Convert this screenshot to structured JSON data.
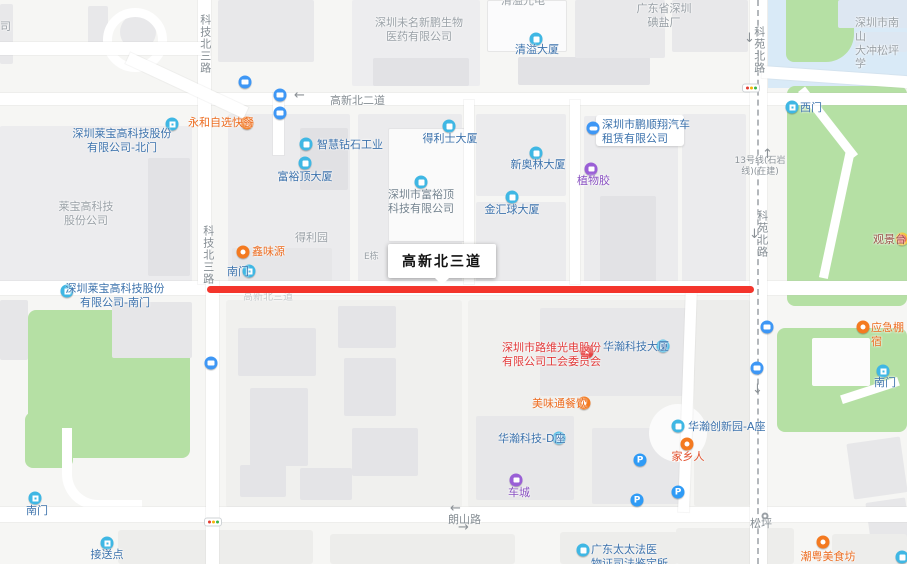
{
  "map": {
    "callout": "高新北三道",
    "roads": {
      "keji_north_3_a": "科技北三路",
      "keji_north_3_b": "科技北三路",
      "gaoxin_north_2": "高新北二道",
      "gaoxin_north_3": "高新北三道",
      "langshan": "朗山路",
      "keyuan_north_a": "科苑北路",
      "keyuan_north_b": "科苑北路",
      "songping": "松坪",
      "metro_line_13": "13号线(石岩\n线)(在建)"
    },
    "pois": {
      "weiming_biopharma": "深圳未名新鹏生物\n医药有限公司",
      "qingyi_optoelectronics": "清溢光电",
      "iodized_salt_factory": "广东省深圳\n碘盐厂",
      "songping_school": "深圳市南山\n大冲松坪学",
      "laibao_hightech": "莱宝高科技\n股份公司",
      "deliyuan": "得利园",
      "building_e": "E栋",
      "edge_fragment_si": "司",
      "qingyi_tower": "清溢大厦",
      "west_gate": "西门",
      "laibao_north_gate": "深圳莱宝高科技股份\n有限公司-北门",
      "zhihui_diamond": "智慧钻石工业",
      "delishi_tower": "得利士大厦",
      "fuyuding_tower": "富裕顶大厦",
      "pengshunxiang_car_rental": "深圳市鹏顺翔汽车\n租赁有限公司",
      "xinaolin_tower": "新奥林大厦",
      "fuyuding_tech": "深圳市富裕顶\n科技有限公司",
      "jinhuiqiu_tower": "金汇球大厦",
      "south_gate_center": "南门",
      "laibao_south_gate": "深圳莱宝高科技股份\n有限公司-南门",
      "xinweiyuan": "鑫味源",
      "yonghe_fastfood": "永和自选快餐",
      "zhiwujiao": "植物胶",
      "luwei_union": "深圳市路维光电股份\n有限公司工会委员会",
      "huahan_tower": "华瀚科技大厦",
      "guanjingtai": "观景台",
      "yingji_shelter": "应急棚宿",
      "meiweitong": "美味通餐饮",
      "huahan_innovation_a": "华瀚创新园-A座",
      "jiaxiangren": "家乡人",
      "huahan_d": "华瀚科技-D座",
      "checheng": "车城",
      "fayi_center": "广东太太法医\n物证司法鉴定所",
      "jiesongdian": "接送点",
      "south_gate_sw": "南门",
      "south_gate_park": "南门",
      "chaoyue_food": "潮粤美食坊"
    },
    "colors": {
      "route_highlight": "#f4352c",
      "park_green": "#b5e0a4",
      "water_blue": "#d9eaf7",
      "poi_blue": "#3c72ac",
      "poi_orange": "#ec6c20",
      "poi_purple": "#8a52c2",
      "poi_red": "#e23a3a"
    }
  }
}
